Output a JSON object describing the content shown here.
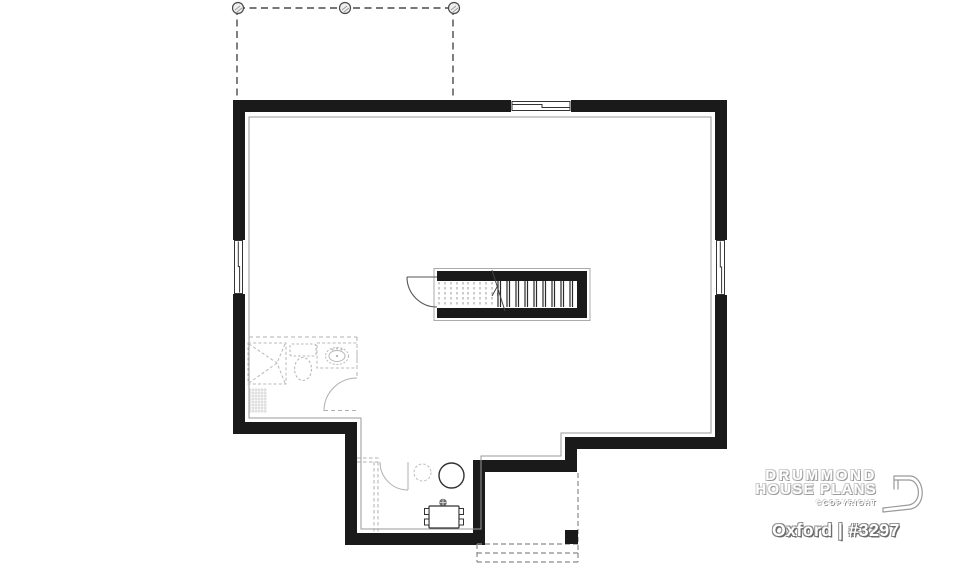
{
  "brand": {
    "name_line1": "DRUMMOND",
    "name_line2": "HOUSE PLANS",
    "copyright_label": "©COPYRIGHT",
    "plan_label": "Oxford | #3297"
  },
  "colors": {
    "background": "#ffffff",
    "wall": "#1a1a1a",
    "interior_face_line": "#9a9a9a",
    "future_dashed": "#b5b5b5",
    "fixture_line": "#b8b8b8",
    "deck_dashed": "#4a4a4a",
    "stair_tread_dashed": "#9a9a9a",
    "stair_tread_solid": "#2a2a2a",
    "brand_text": "#ffffff",
    "brand_shadow": "#8a8a8a"
  }
}
